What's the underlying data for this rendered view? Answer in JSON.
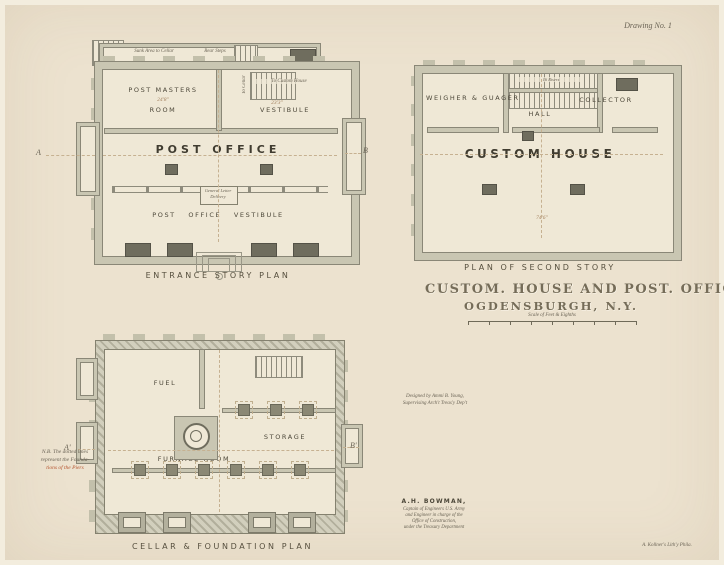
{
  "header": {
    "drawing_no": "Drawing No. 1"
  },
  "title_block": {
    "line1": "CUSTOM. HOUSE AND POST. OFFICE,",
    "line2": "OGDENSBURGH, N.Y.",
    "scale": "Scale of Feet & Eighths"
  },
  "entrance_plan": {
    "caption": "ENTRANCE STORY PLAN",
    "sunk_area": "Sunk Area to Cellar",
    "rear_steps": "Rear Steps",
    "room1_line1": "POST MASTERS",
    "room1_line2": "ROOM",
    "room1_dim": "24'8\"",
    "vestibule": "VESTIBULE",
    "vestibule_dim": "23'3\"",
    "stair_note": "To Custom House",
    "stair_note2": "To Cellar",
    "hall": "POST OFFICE",
    "lower": "POST OFFICE VESTIBULE",
    "delivery_line1": "General Letter",
    "delivery_line2": "Delivery",
    "marker_left": "A",
    "marker_right": "B"
  },
  "second_story_plan": {
    "caption": "PLAN OF SECOND STORY",
    "room1": "WEIGHER & GUAGER",
    "room2": "COLLECTOR",
    "hall": "HALL",
    "main": "CUSTOM HOUSE",
    "stair_note": "16 Risers",
    "dim": "74'6\""
  },
  "cellar_plan": {
    "caption": "CELLAR & FOUNDATION PLAN",
    "fuel": "FUEL",
    "furnace": "FURNACE ROOM",
    "storage": "STORAGE",
    "marker_left": "A'",
    "marker_right": "B'"
  },
  "note": {
    "line1": "N.B. The dotted lines",
    "line2": "represent the Founda-",
    "line3": "tions of the Piers"
  },
  "credits": {
    "designed_line1": "Designed by Ammi B. Young,",
    "designed_line2": "Supervising Arch't Treas'y Dep't",
    "engineer_name": "A.H. BOWMAN,",
    "engineer_line1": "Captain of Engineers U.S. Army",
    "engineer_line2": "and Engineer in charge of the",
    "engineer_line3": "Office of Construction,",
    "engineer_line4": "under the Treasury Department",
    "litho": "A. Kollner's Lith'y Phila."
  },
  "colors": {
    "paper": "#ece2cf",
    "wall": "#c9c6b2",
    "wall_outline": "#8a8777",
    "ink": "#4c4739",
    "accent_red": "#b5542f",
    "dim_sepia": "#a3805e"
  }
}
